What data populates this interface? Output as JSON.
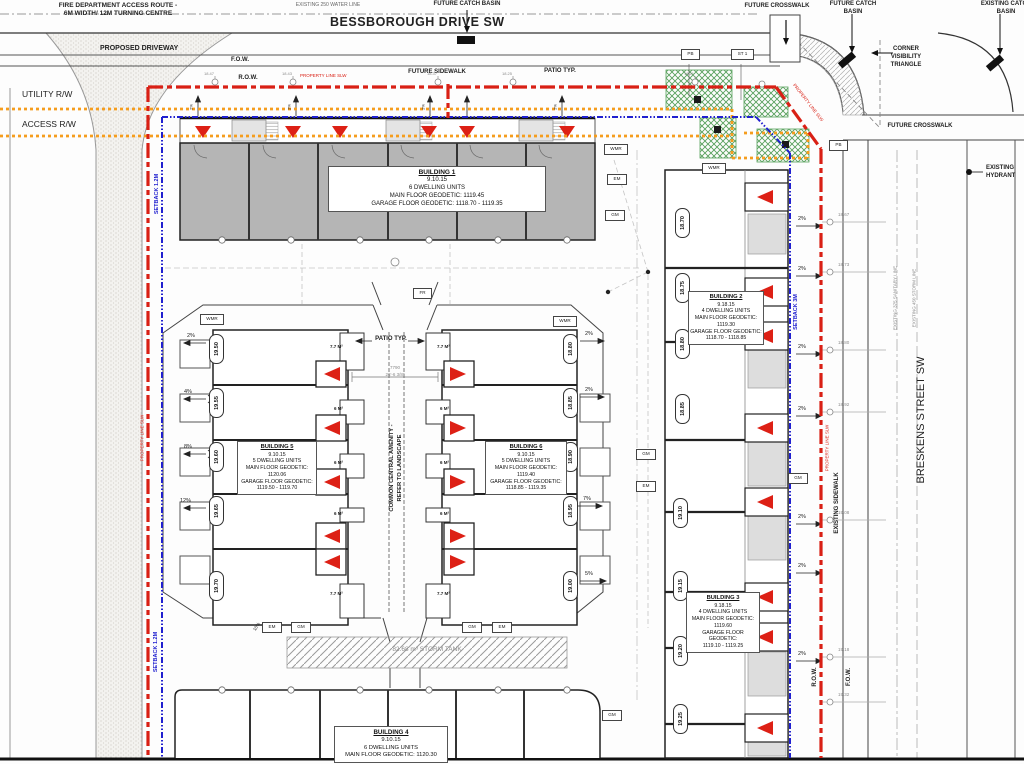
{
  "streets": {
    "bessborough": "BESSBOROUGH DRIVE SW",
    "breskens": "BRESKENS STREET SW"
  },
  "labels": {
    "fire1": "FIRE DEPARTMENT ACCESS ROUTE -",
    "fire2": "6M WIDTH/ 12M TURNING CENTRE",
    "water": "EXISTING 250 WATER LINE",
    "future_catch": "FUTURE CATCH BASIN",
    "future_catch_1": "FUTURE CATCH",
    "future_catch_2": "BASIN",
    "existing_catch_1": "EXISTING CATCH",
    "existing_catch_2": "BASIN",
    "future_crosswalk": "FUTURE CROSSWALK",
    "corner_1": "CORNER",
    "corner_2": "VISIBILITY",
    "corner_3": "TRIANGLE",
    "proposed_driveway": "PROPOSED DRIVEWAY",
    "fow": "F.O.W.",
    "row": "R.O.W.",
    "future_sidewalk": "FUTURE SIDEWALK",
    "patio_typ": "PATIO TYP.",
    "property_line": "PROPERTY LINE SLW",
    "utility_rw": "UTILITY R/W",
    "access_rw": "ACCESS R/W",
    "setback_12": "SETBACK 1.2M",
    "setback_3": "SETBACK 3M",
    "existing_sidewalk": "EXISTING SIDEWALK",
    "existing_hydrant_1": "EXISTING",
    "existing_hydrant_2": "HYDRANT",
    "sanitary": "EXISTING 375 SANITARY LINE",
    "storm": "EXISTING 450 STORM LINE",
    "amenity_1": "COMMON CENTRAL AMENITY -",
    "amenity_2": "REFER TO LANDSCAPE",
    "storm_tank": "82.68 m³ STORM TANK",
    "dim_mm": "7790",
    "dim_ft": "26'-6 3/8\"",
    "slope_10": "10%"
  },
  "boxes": {
    "wmr": "WMR",
    "em": "EM",
    "gm": "GM",
    "fr": "FR",
    "pb": "PB",
    "st1": "ST 1"
  },
  "buildings": {
    "b1": {
      "title": "BUILDING 1",
      "date": "9.10.15",
      "units": "6 DWELLING UNITS",
      "main": "MAIN FLOOR GEODETIC: 1119.45",
      "garage": "GARAGE FLOOR GEODETIC: 1118.70 - 1119.35"
    },
    "b2": {
      "title": "BUILDING 2",
      "date": "9.18.15",
      "units": "4 DWELLING UNITS",
      "main_label": "MAIN FLOOR GEODETIC:",
      "main_value": "1119.30",
      "garage_label": "GARAGE FLOOR GEODETIC:",
      "garage_value": "1118.70 - 1118.85"
    },
    "b3": {
      "title": "BUILDING 3",
      "date": "9.18.15",
      "units": "4 DWELLING UNITS",
      "main_label": "MAIN FLOOR GEODETIC:",
      "main_value": "1119.60",
      "garage_label": "GARAGE FLOOR GEODETIC:",
      "garage_value": "1119.10 - 1119.25"
    },
    "b4": {
      "title": "BUILDING 4",
      "date": "9.10.15",
      "units": "6 DWELLING UNITS",
      "main": "MAIN FLOOR GEODETIC: 1120.30"
    },
    "b5": {
      "title": "BUILDING 5",
      "date": "9.10.15",
      "units": "5 DWELLING UNITS",
      "main_label": "MAIN FLOOR GEODETIC:",
      "main_value": "1120.06",
      "garage_label": "GARAGE FLOOR GEODETIC:",
      "garage_value": "1119.50 - 1119.70"
    },
    "b6": {
      "title": "BUILDING 6",
      "date": "9.10.15",
      "units": "5 DWELLING UNITS",
      "main_label": "MAIN FLOOR GEODETIC:",
      "main_value": "1119.40",
      "garage_label": "GARAGE FLOOR GEODETIC:",
      "garage_value": "1118.85 - 1119.35"
    }
  },
  "elevations": {
    "west": [
      "19.50",
      "19.55",
      "19.60",
      "19.65",
      "19.70"
    ],
    "east_center": [
      "18.80",
      "18.85",
      "18.90",
      "18.95",
      "19.00"
    ],
    "col2": [
      "18.70",
      "18.75",
      "18.80",
      "18.85"
    ],
    "col3": [
      "19.10",
      "19.15",
      "19.20",
      "19.25"
    ]
  },
  "spots": {
    "top": [
      "18.47",
      "18.43",
      "18.37",
      "18.25",
      "18.21"
    ],
    "east": [
      "18.67",
      "18.73",
      "18.80",
      "18.92",
      "19.08",
      "19.18",
      "19.32"
    ]
  },
  "slopes": {
    "west": [
      "2%",
      "4%",
      "8%",
      "12%"
    ],
    "east_inner": [
      "2%",
      "2%",
      "7%",
      "5%"
    ],
    "east": "2%",
    "north": "2%"
  },
  "patios": {
    "large": "7.7 M²",
    "small": "6 M²"
  },
  "colors": {
    "property_red": "#d92015",
    "utility_orange": "#f59d1e",
    "setback_blue": "#2020cf",
    "building_grey": "#b5b5b5",
    "landscape_green": "#57a05c"
  }
}
